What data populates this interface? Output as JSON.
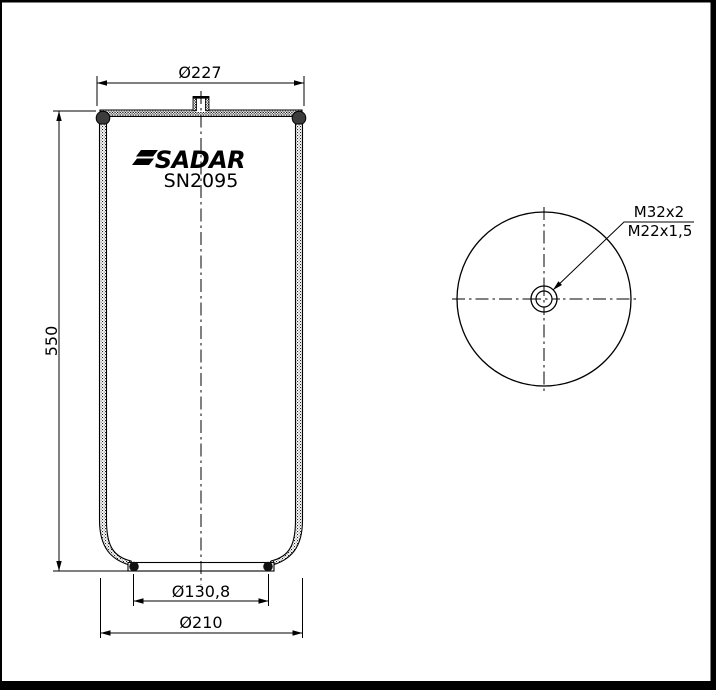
{
  "colors": {
    "ink": "#000000",
    "paper": "#ffffff"
  },
  "side_view": {
    "brand": "SADAR",
    "model": "SN2095",
    "dim_top_plate_diameter": "Ø227",
    "dim_height": "550",
    "dim_piston_diameter": "Ø130,8",
    "dim_base_diameter": "Ø210"
  },
  "top_view": {
    "thread_outer": "M32x2",
    "thread_inner": "M22x1,5"
  }
}
